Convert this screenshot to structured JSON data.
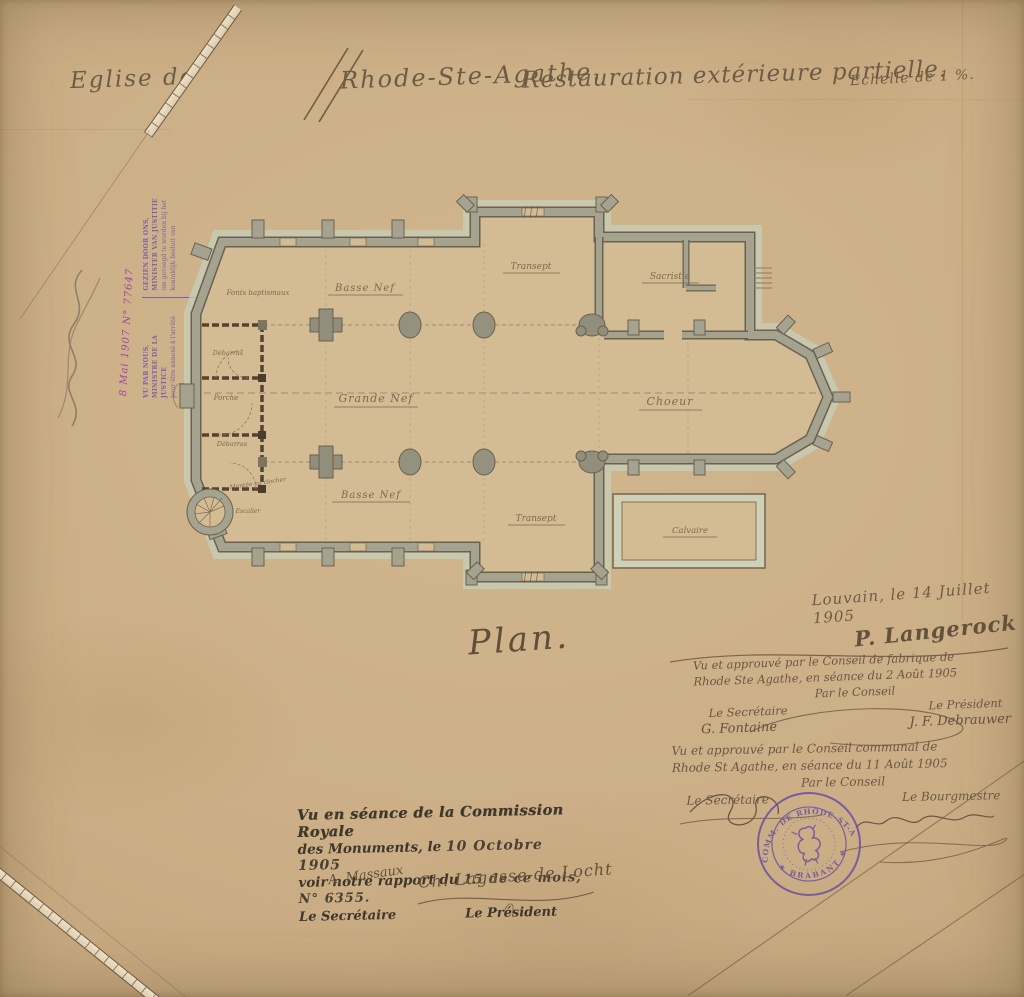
{
  "title": {
    "prefix": "Eglise de",
    "name": "Rhode-Ste-Agathe.",
    "subtitle": "Restauration extérieure partielle.",
    "scale": "Echelle de 1 %."
  },
  "plan": {
    "caption": "Plan.",
    "labels": {
      "fonts_baptismaux": "Fonts baptismaux",
      "basse_nef_nord": "Basse Nef",
      "grande_nef": "Grande Nef",
      "basse_nef_sud": "Basse Nef",
      "transept_nord": "Transept",
      "transept_sud": "Transept",
      "sacristie": "Sacristie",
      "choeur": "Choeur",
      "calvaire": "Calvaire",
      "porche": "Porche",
      "debarras_haut": "Débarras",
      "debarras_bas": "Débarras",
      "montee": "Montée au clocher",
      "escalier": "Escalier"
    }
  },
  "ministry_stamp": {
    "fr_line1": "VU PAR NOUS, MINISTRE DE LA JUSTICE",
    "fr_line2": "pour être annexé à l'arrêté royal",
    "fr_line3": "du",
    "nl_line1": "GEZIEN DOOR ONS, MINISTER VAN JUSTITIE",
    "nl_line2": "om gevoegd te worden bij het",
    "nl_line3": "koninklijk besluit van",
    "hand_note": "8 Mai 1907 N° 77647"
  },
  "date_place": "Louvain, le 14 Juillet 1905",
  "architect_signature": "P. Langerock",
  "fabrique_approval": {
    "line1": "Vu et approuvé par le Conseil de fabrique de",
    "line2": "Rhode Ste Agathe, en séance du 2 Août 1905",
    "par": "Par le Conseil",
    "secretary_label": "Le Secrétaire",
    "secretary_name": "G. Fontaine",
    "president_label": "Le Président",
    "president_name": "J. F. Debrauwer"
  },
  "communal_approval": {
    "line1": "Vu et approuvé par le Conseil communal de",
    "line2": "Rhode St Agathe, en séance du 11 Août 1905",
    "par": "Par le Conseil",
    "secretary_label": "Le Secrétaire",
    "burgomaster_label": "Le Bourgmestre"
  },
  "commission_stamp": {
    "line1": "Vu en séance de la Commission Royale",
    "line2_static": "des Monuments, le",
    "line2_hand": "10 Octobre 1905",
    "line3_static": "voir notre rapport du",
    "line3_hand": "15 de ce mois, N° 6355.",
    "secretary_label": "Le Secrétaire",
    "president_label": "Le Président",
    "secretary_signature": "A. Massaux",
    "president_signature": "Ch. Lagasse-de Locht"
  },
  "commune_seal": {
    "top_text": "ADM. COMM. DE RHODE-ST-AGATHE",
    "bottom_text": "✶ BRABANT ✶"
  },
  "colors": {
    "paper": "#cbae85",
    "ink": "#6d5c44",
    "wall": "#a5a28f",
    "wall_outline": "#6a6150",
    "light_wash": "#c6cdb7",
    "interior": "#d3bc93",
    "stamp_purple": "#7b5fa8",
    "seal_purple": "#6a4fa3",
    "violet_hand": "#a344a0",
    "black_stamp": "#3d362b"
  }
}
